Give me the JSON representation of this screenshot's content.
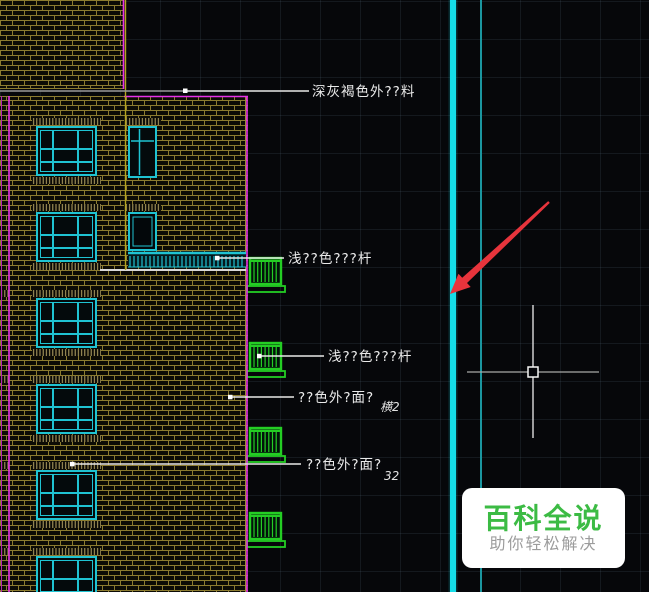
{
  "viewport": {
    "background": "#06070a",
    "grid_color": "#2a3440"
  },
  "colors": {
    "brick_mortar": "#8c7c30",
    "window_frame": "#1fc3d2",
    "railing_green": "#24cd24",
    "outline_magenta": "#e832e8",
    "axis_yellow": "#b3a31f",
    "floor_line": "#d8d8d8",
    "guide_cyan_bright": "#15dde8",
    "guide_teal_dim": "#1b96a0",
    "arrow_red": "#e7343c",
    "label_text": "#eaeaea"
  },
  "labels": [
    {
      "id": "facade-material",
      "text": "深灰褐色外??料"
    },
    {
      "id": "railing-upper",
      "text": "浅??色???杆"
    },
    {
      "id": "railing-lower",
      "text": "浅??色???杆"
    },
    {
      "id": "wall-finish-1",
      "text": "??色外?面?",
      "suffix": "横2"
    },
    {
      "id": "wall-finish-2",
      "text": "??色外?面?",
      "suffix": "32"
    }
  ],
  "watermark": {
    "title": "百科全说",
    "subtitle": "助你轻松解决",
    "title_color": "#3cbb44",
    "subtitle_color": "#9c9c9c",
    "background": "#ffffff"
  }
}
